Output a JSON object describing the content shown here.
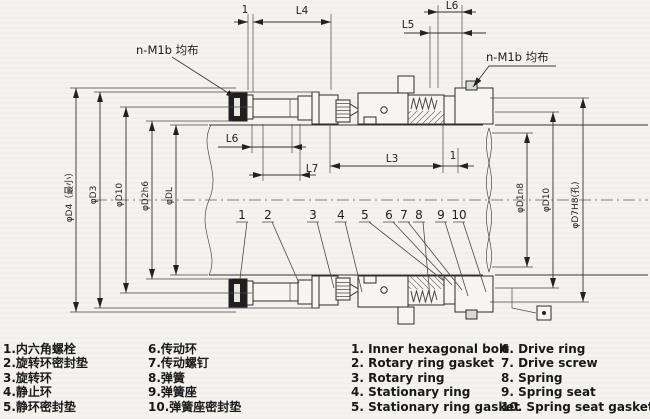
{
  "colors": {
    "paper": "#f4f3ef",
    "ink": "#2c2c2c",
    "dim_line": "#333333"
  },
  "drawing": {
    "leader_left": "n-M1b 均布",
    "leader_right": "n-M1b 均布",
    "dims_top": {
      "t1": "1",
      "l4": "L4",
      "l5": "L5",
      "l6": "L6"
    },
    "dims_mid": {
      "l6": "L6",
      "l7": "L7",
      "l3": "L3",
      "t2": "1"
    },
    "dims_left": [
      "φD4（最小）",
      "φD3",
      "φD10",
      "φD2h6",
      "φDL"
    ],
    "dims_right": [
      "φD1n8",
      "φD10",
      "φD7H8(孔)"
    ],
    "callouts": [
      "1",
      "2",
      "3",
      "4",
      "5",
      "6",
      "7",
      "8",
      "9",
      "10"
    ]
  },
  "legend": {
    "zh_col1": [
      "1.内六角螺栓",
      "2.旋转环密封垫",
      "3.旋转环",
      "4.静止环",
      "5.静环密封垫"
    ],
    "zh_col2": [
      "6.传动环",
      "7.传动螺钉",
      "8.弹簧",
      "9.弹簧座",
      "10.弹簧座密封垫"
    ],
    "en_col1": [
      "1. Inner hexagonal bolt",
      "2. Rotary ring gasket",
      "3. Rotary ring",
      "4. Stationary ring",
      "5. Stationary ring gasket"
    ],
    "en_col2": [
      "6. Drive ring",
      "7. Drive screw",
      "8. Spring",
      "9. Spring seat",
      "10. Spring seat gasket"
    ]
  }
}
